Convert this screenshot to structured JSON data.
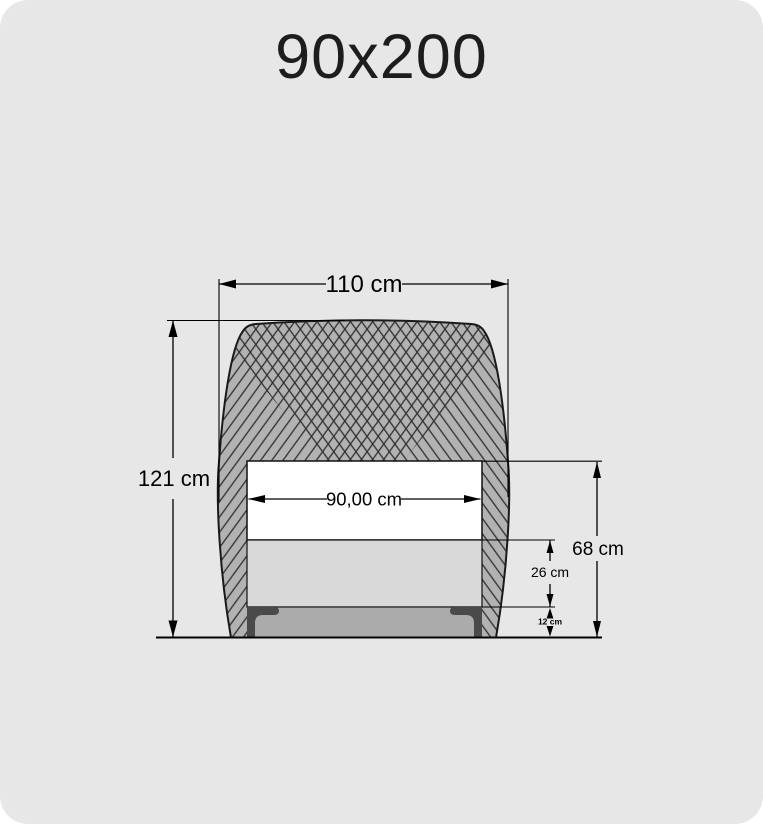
{
  "page": {
    "title": "90x200"
  },
  "diagram": {
    "labels": {
      "outer_width": "110 cm",
      "total_height": "121 cm",
      "inner_width": "90,00 cm",
      "top_height": "68 cm",
      "frame_band_height": "26 cm",
      "base_height": "12 cm"
    },
    "colors": {
      "page_background": "#e7e7e7",
      "upholstery_fill": "#b2b2b2",
      "hatch_line": "#2e2e2e",
      "mattress_fill": "#ffffff",
      "frame_band_fill": "#d9d9d9",
      "base_fill": "#ababab",
      "bracket_fill": "#4a4a4a",
      "outline": "#1a1a1a",
      "dimension_line": "#000000"
    }
  }
}
